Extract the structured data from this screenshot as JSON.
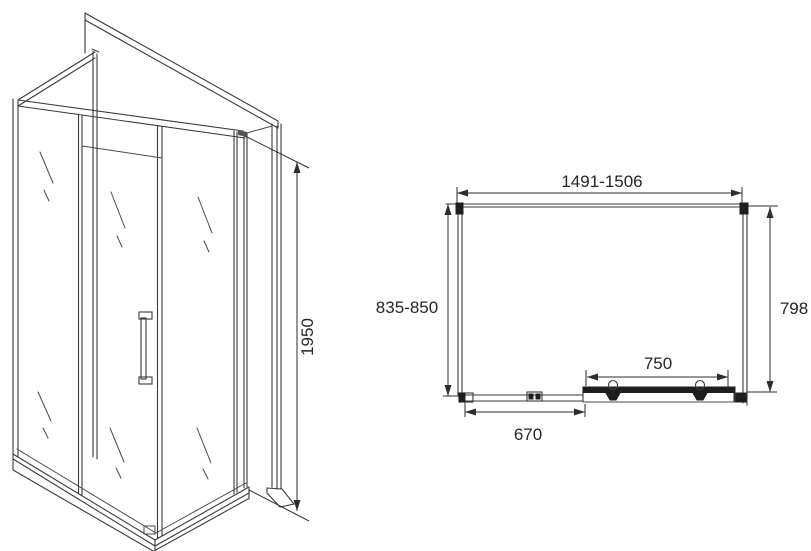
{
  "drawing": {
    "side_view": {
      "height_label": "1950"
    },
    "plan_view": {
      "width_label": "1491-1506",
      "depth_label": "835-850",
      "inner_depth_label": "798",
      "door_width_label": "750",
      "fixed_panel_label": "670"
    },
    "colors": {
      "line": "#3a3a3a",
      "text": "#262626",
      "background": "#ffffff"
    }
  }
}
